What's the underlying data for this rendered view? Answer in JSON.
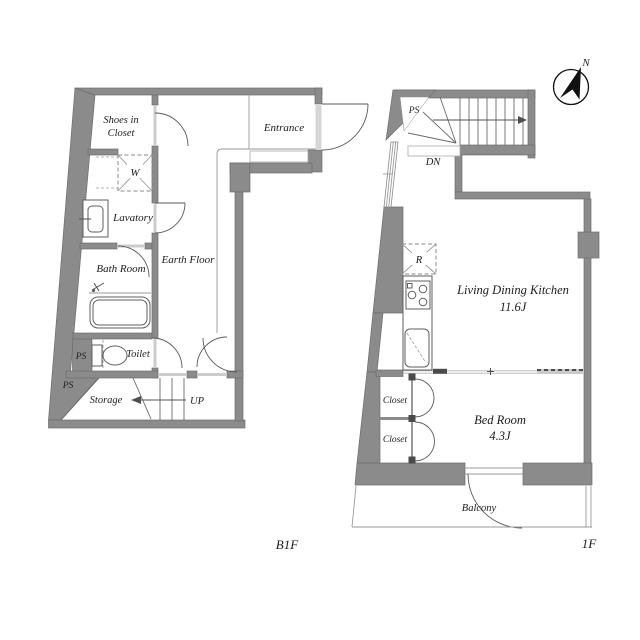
{
  "page": {
    "width": 640,
    "height": 640,
    "background": "#ffffff"
  },
  "colors": {
    "wall": "#8b8b8b",
    "wall_edge": "#6e6e6e",
    "line": "#4f4f4f",
    "thin_line": "#9a9a9a",
    "threshold": "#cccccc",
    "dashed": "#8a8a8a",
    "text": "#1c1c1c"
  },
  "b1f": {
    "floor_label": "B1F",
    "labels": {
      "shoes_in_closet_line1": "Shoes in",
      "shoes_in_closet_line2": "Closet",
      "entrance": "Entrance",
      "washing_machine": "W",
      "lavatory": "Lavatory",
      "bath_room": "Bath Room",
      "earth_floor": "Earth Floor",
      "toilet": "Toilet",
      "pipe_shaft_upper": "PS",
      "pipe_shaft_lower": "PS",
      "storage": "Storage",
      "stairs_up": "UP"
    }
  },
  "f1": {
    "floor_label": "1F",
    "labels": {
      "pipe_shaft": "PS",
      "stairs_down": "DN",
      "refrigerator": "R",
      "living_dining_kitchen": "Living Dining Kitchen",
      "living_dining_kitchen_size": "11.6J",
      "closet_upper": "Closet",
      "closet_lower": "Closet",
      "bed_room": "Bed Room",
      "bed_room_size": "4.3J",
      "balcony": "Balcony"
    }
  },
  "compass": {
    "north_label": "N"
  }
}
